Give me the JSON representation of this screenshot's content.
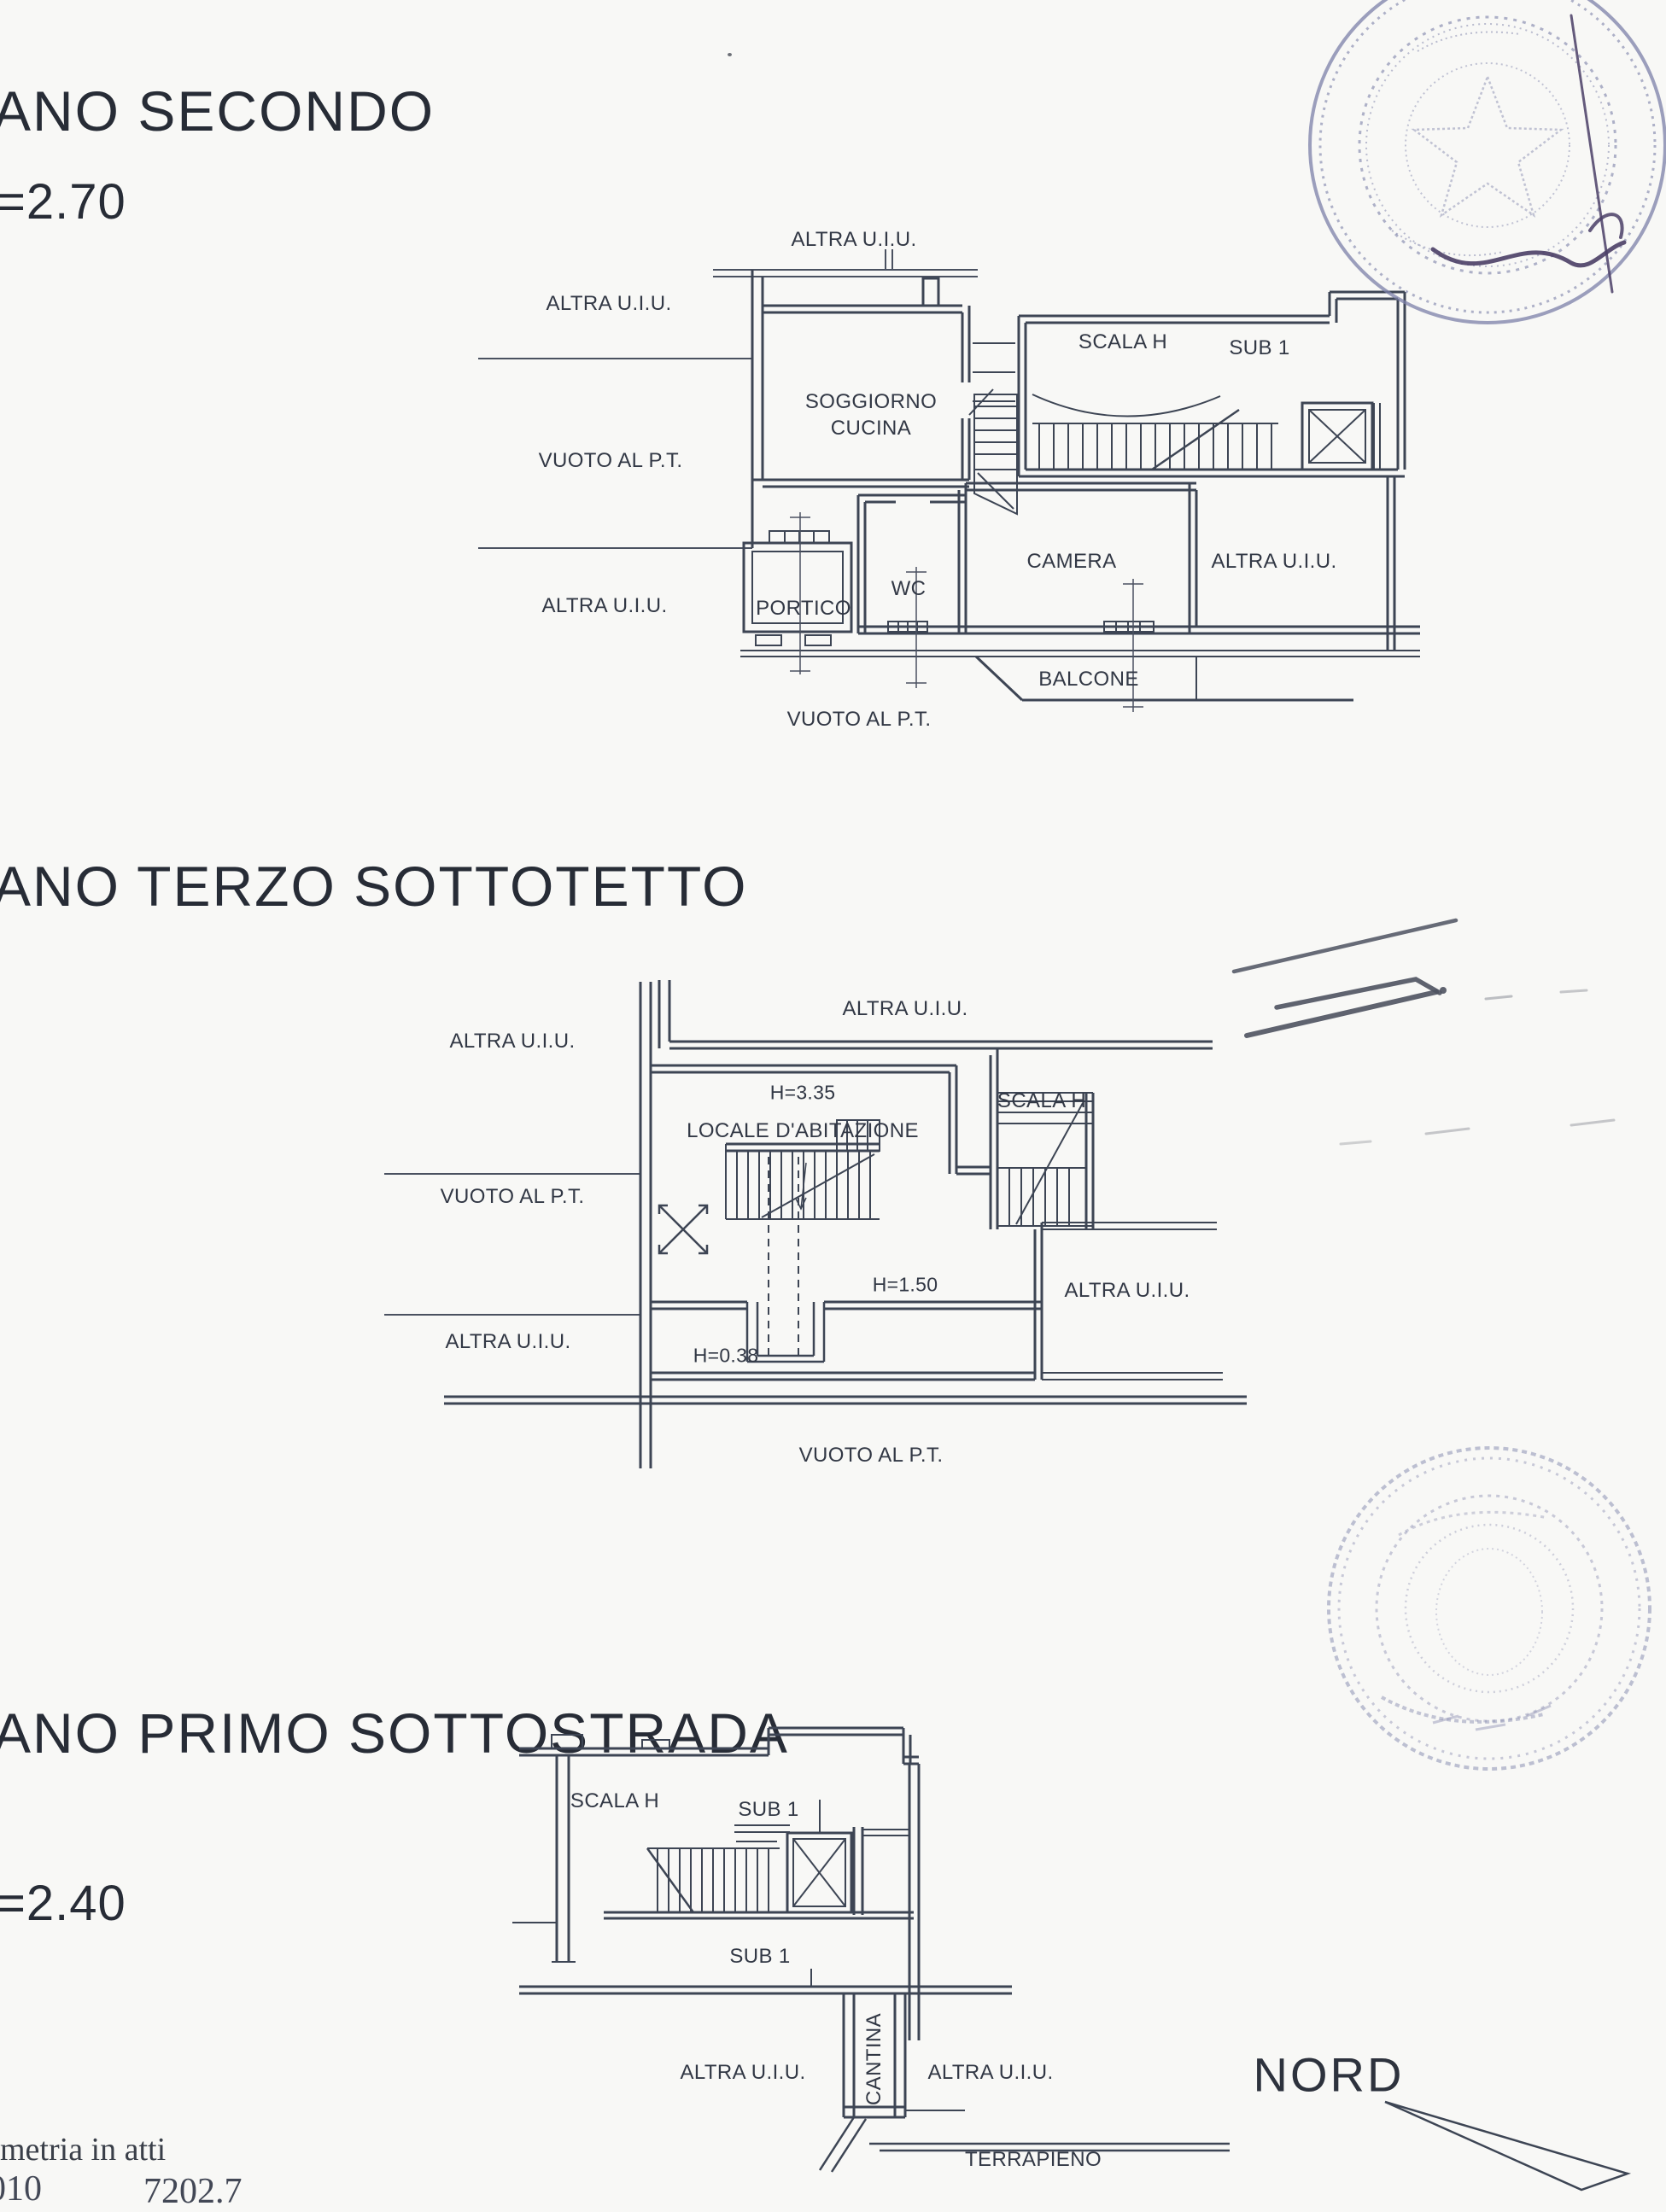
{
  "sections": {
    "secondo": {
      "title": "ANO SECONDO",
      "height_note": "=2.70",
      "labels": {
        "altra_top": "ALTRA U.I.U.",
        "altra_left_upper": "ALTRA U.I.U.",
        "vuoto_left": "VUOTO AL P.T.",
        "altra_left_lower": "ALTRA U.I.U.",
        "soggiorno_line1": "SOGGIORNO",
        "soggiorno_line2": "CUCINA",
        "scala": "SCALA H",
        "sub": "SUB 1",
        "wc": "WC",
        "camera": "CAMERA",
        "altra_right": "ALTRA U.I.U.",
        "portico": "PORTICO",
        "balcone": "BALCONE",
        "vuoto_bottom": "VUOTO AL P.T."
      }
    },
    "terzo": {
      "title": "ANO TERZO SOTTOTETTO",
      "labels": {
        "altra_top": "ALTRA U.I.U.",
        "altra_left": "ALTRA U.I.U.",
        "h_max": "H=3.35",
        "locale": "LOCALE D'ABITAZIONE",
        "scala": "SCALA H",
        "vuoto_left": "VUOTO AL P.T.",
        "h_mid": "H=1.50",
        "altra_right": "ALTRA U.I.U.",
        "altra_left_lower": "ALTRA U.I.U.",
        "h_min": "H=0.38",
        "vuoto_bottom": "VUOTO AL P.T."
      }
    },
    "primo": {
      "title": "ANO PRIMO SOTTOSTRADA",
      "height_note": "=2.40",
      "labels": {
        "scala": "SCALA H",
        "sub_upper": "SUB 1",
        "sub_lower": "SUB 1",
        "cantina": "CANTINA",
        "altra_left": "ALTRA U.I.U.",
        "altra_right": "ALTRA U.I.U.",
        "terrapieno": "TERRAPIENO"
      }
    }
  },
  "compass": {
    "label": "NORD"
  },
  "footer": {
    "note": "metria in atti",
    "fragment_left": "010",
    "fragment_right": "7202.7"
  },
  "colors": {
    "ink": "#3d4554",
    "paper": "#f8f8f6",
    "stamp": "#7c80a8",
    "signature": "#4a3e66"
  }
}
